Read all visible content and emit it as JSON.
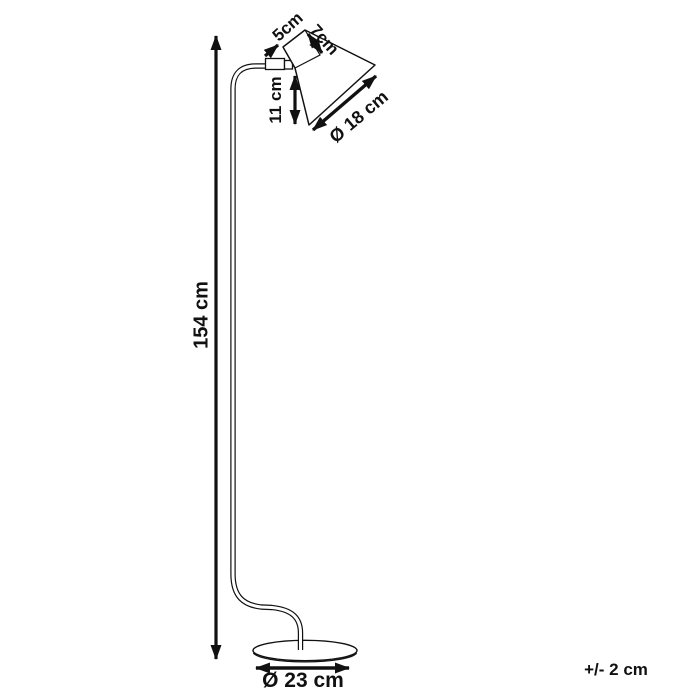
{
  "diagram": {
    "type": "product-dimension-drawing",
    "subject": "floor lamp with conical shade, arched arm and round base",
    "colors": {
      "line": "#111111",
      "background": "#ffffff"
    },
    "labels": {
      "shade_top_width": "5cm",
      "shade_neck_depth": "7cm",
      "shade_height": "11 cm",
      "shade_diameter": "Ø 18 cm",
      "lamp_height": "154 cm",
      "base_diameter": "Ø 23 cm",
      "tolerance": "+/- 2 cm"
    }
  }
}
